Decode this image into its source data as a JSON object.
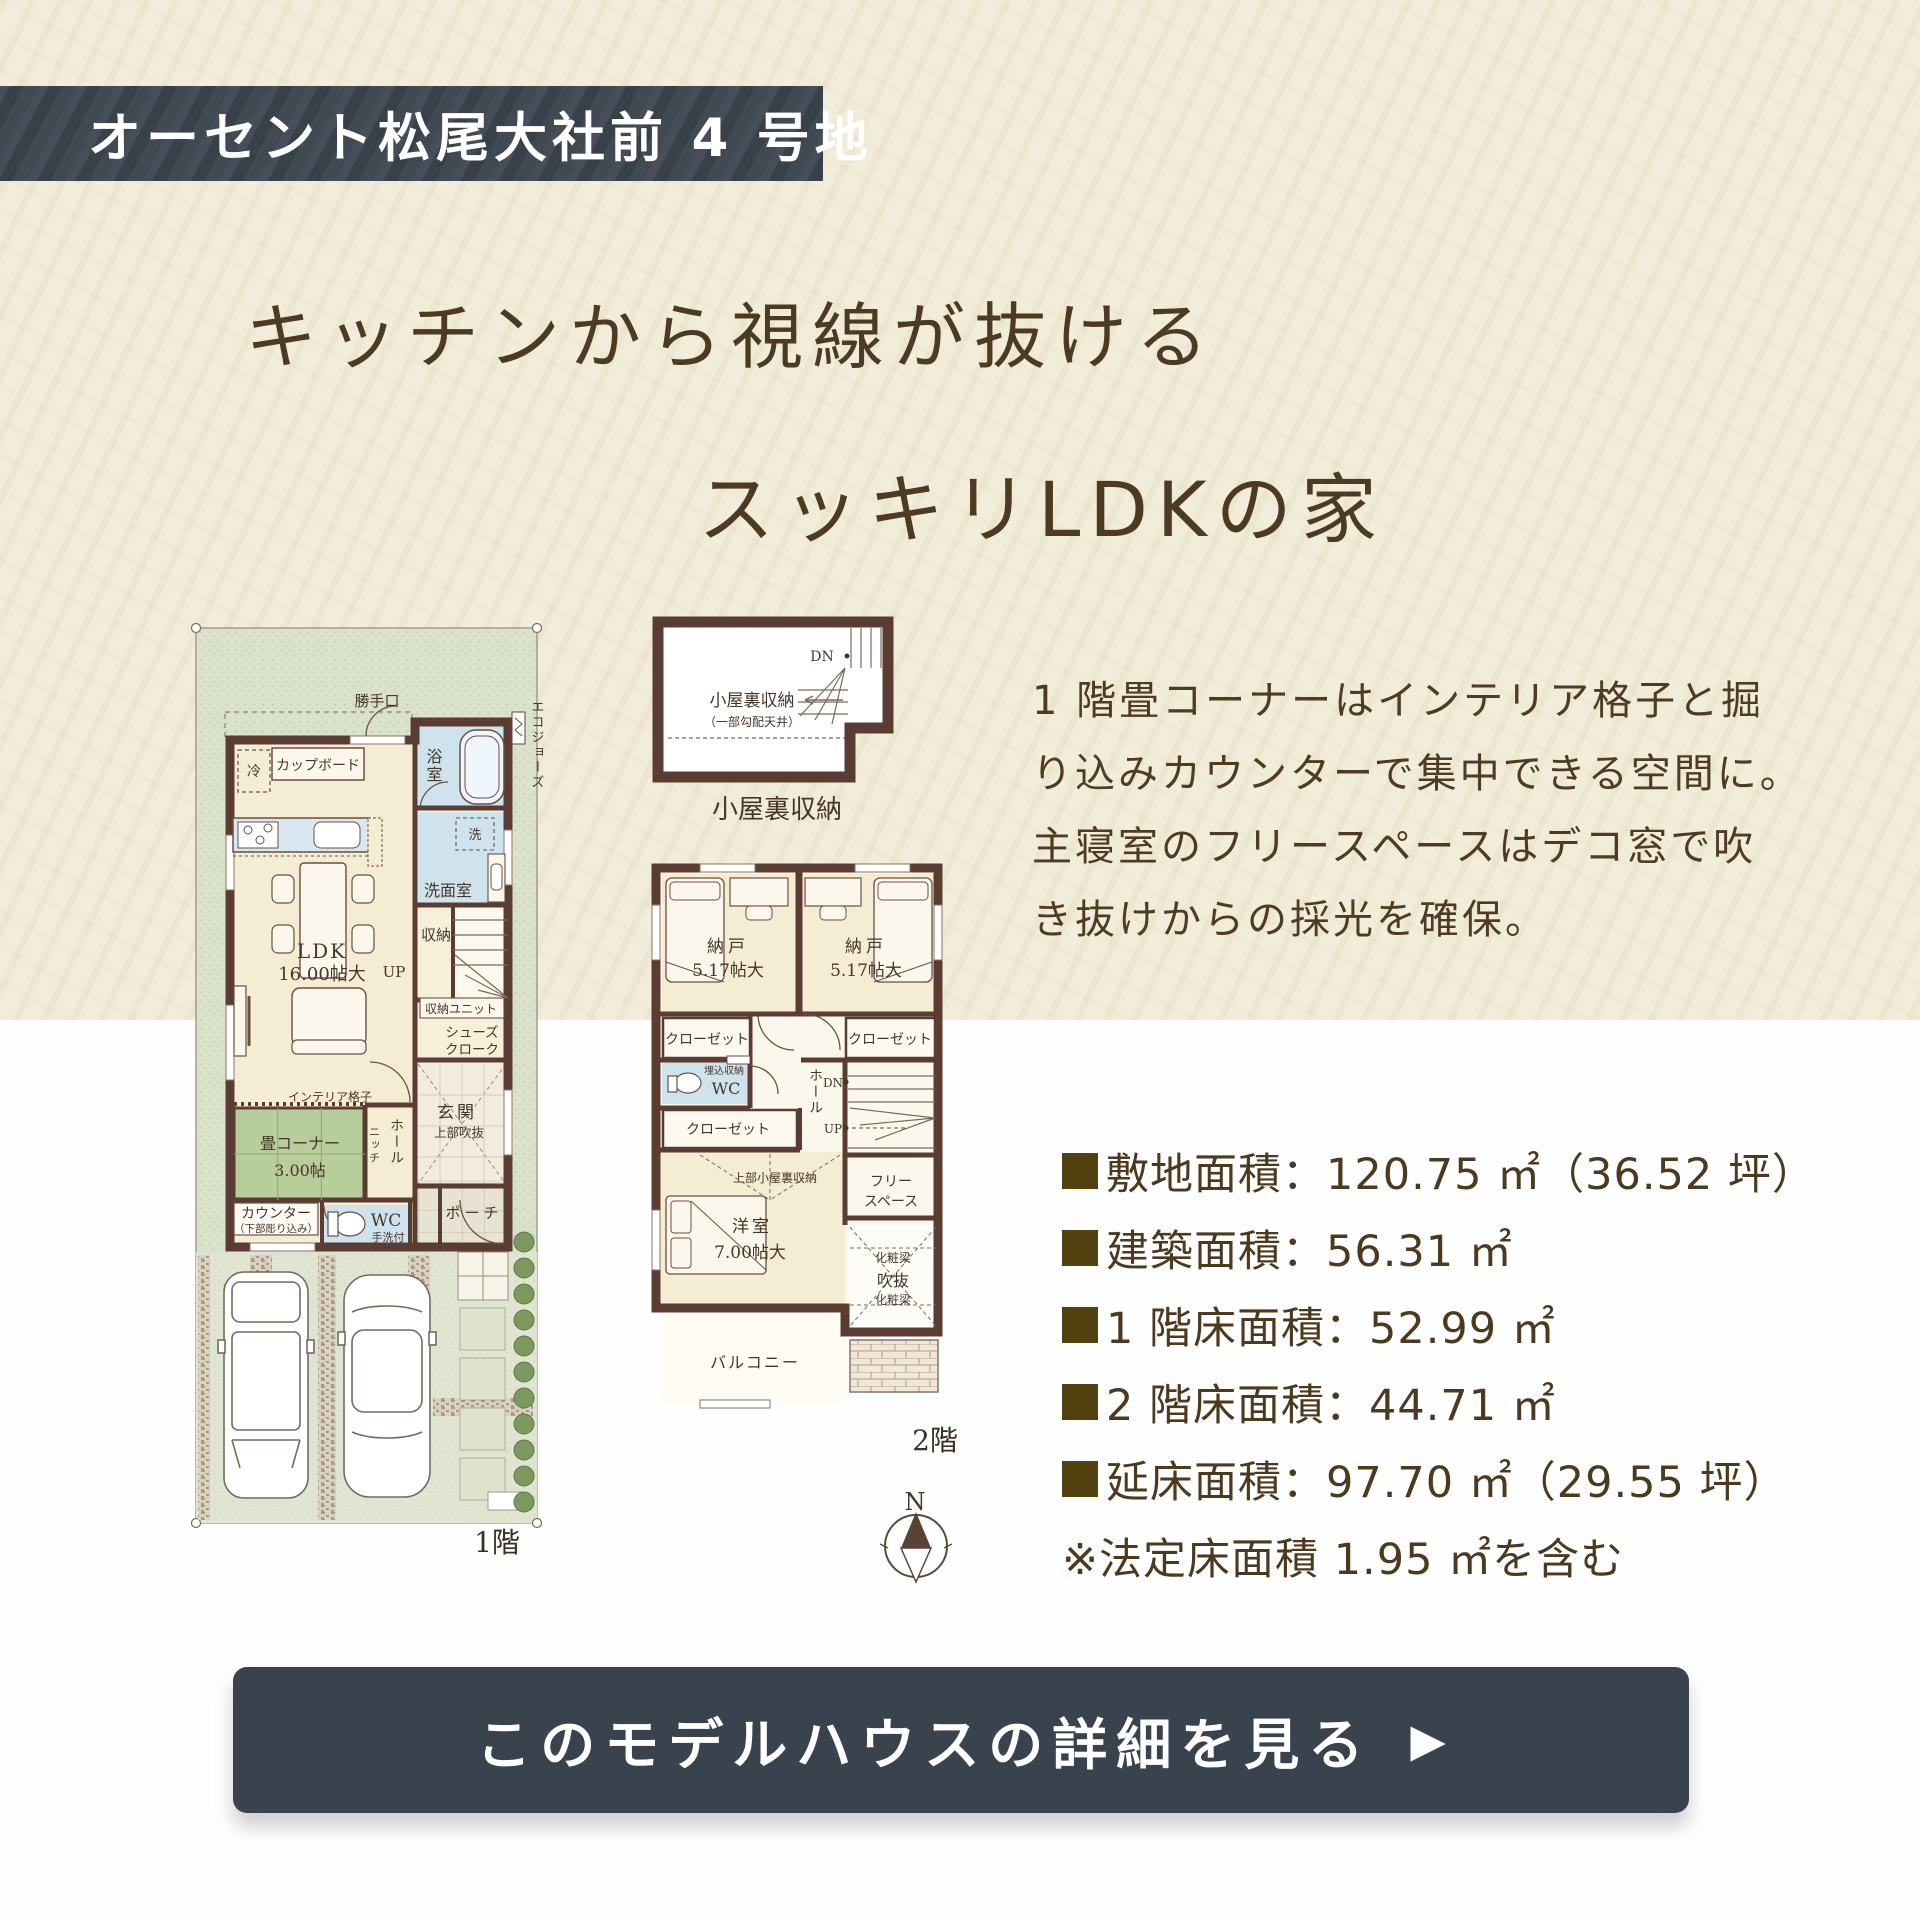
{
  "badge": {
    "label": "オーセント松尾大社前 4 号地"
  },
  "title": {
    "line1": "キッチンから視線が抜ける",
    "line2": "スッキリLDKの家"
  },
  "description": {
    "lines": [
      "1 階畳コーナーはインテリア格子と掘",
      "り込みカウンターで集中できる空間に。",
      "主寝室のフリースペースはデコ窓で吹",
      "き抜けからの採光を確保。"
    ]
  },
  "specs": {
    "items": [
      {
        "text": "敷地面積：120.75 ㎡（36.52 坪）"
      },
      {
        "text": "建築面積：56.31 ㎡"
      },
      {
        "text": "1 階床面積：52.99 ㎡"
      },
      {
        "text": "2 階床面積：44.71 ㎡"
      },
      {
        "text": "延床面積：97.70 ㎡（29.55 坪）"
      }
    ],
    "note": "※法定床面積 1.95 ㎡を含む"
  },
  "cta": {
    "label": "このモデルハウスの詳細を見る",
    "arrow": "▶"
  },
  "plan1f": {
    "caption": "1階",
    "labels": {
      "katteguchi": "勝手口",
      "ecojozu": "エコジョーズ",
      "rei": "冷",
      "cupboard": "カップボード",
      "bath": "浴室",
      "washer": "洗",
      "senmen": "洗面室",
      "shuno": "収納",
      "ldk": "LDK",
      "ldk_size": "16.00帖大",
      "up": "UP",
      "shuno_unit": "収納ユニット",
      "shoes1": "シューズ",
      "shoes2": "クローク",
      "interior_koshi": "インテリア格子",
      "hall": "ホール",
      "niche": "ニッチ",
      "genkan": "玄関",
      "genkan_note": "上部吹抜",
      "tatami": "畳コーナー",
      "tatami_size": "3.00帖",
      "counter": "カウンター",
      "counter_note": "（下部彫り込み）",
      "wc": "WC",
      "wc_note": "手洗付",
      "porch": "ポーチ"
    }
  },
  "attic": {
    "caption": "小屋裏収納",
    "room": "小屋裏収納",
    "room_note": "（一部勾配天井）",
    "dn": "DN"
  },
  "plan2f": {
    "caption": "2階",
    "labels": {
      "nando_l": "納戸",
      "nando_l_size": "5.17帖大",
      "nando_r": "納戸",
      "nando_r_size": "5.17帖大",
      "closet_l": "クローゼット",
      "closet_r": "クローゼット",
      "closet_b": "クローゼット",
      "wc": "WC",
      "wc_note": "埋込収納",
      "hall": "ホール",
      "dn": "DN",
      "up": "UP",
      "attic_over": "上部小屋裏収納",
      "yoshitsu": "洋室",
      "yoshitsu_size": "7.00帖大",
      "free1": "フリー",
      "free2": "スペース",
      "beam_top": "化粧梁",
      "void": "吹抜",
      "beam_bottom": "化粧梁",
      "balcony": "バルコニー"
    }
  },
  "compass": {
    "label": "N"
  }
}
